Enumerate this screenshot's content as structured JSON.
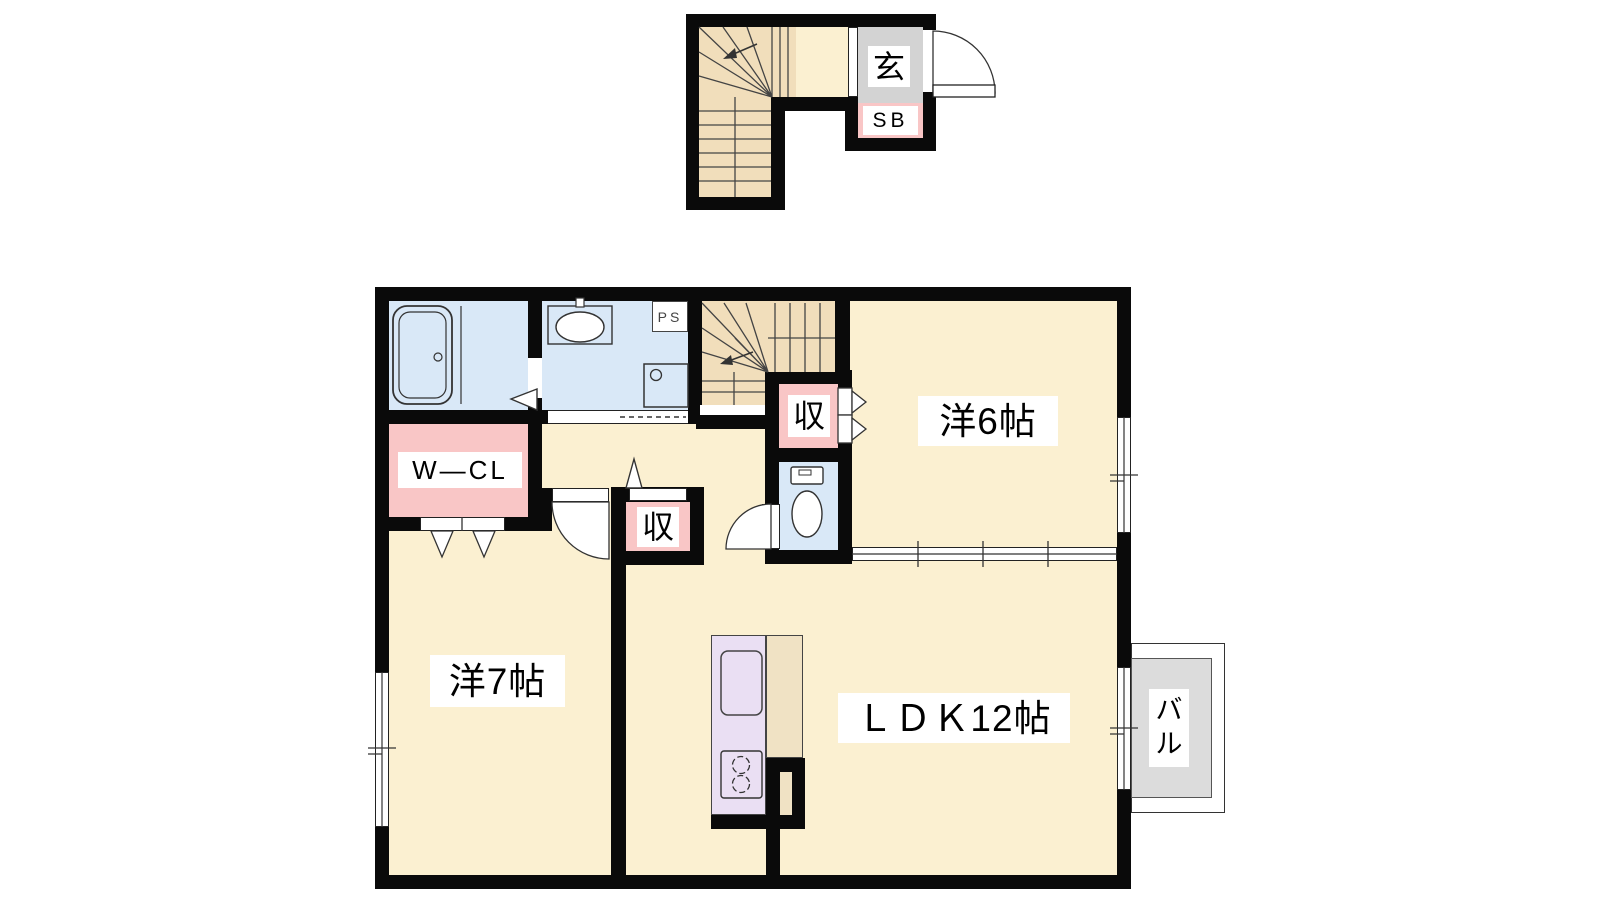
{
  "title": "apartment-floor-plan",
  "labels": {
    "genkan": "玄",
    "shoe_box": "SB",
    "pipe_space": "PS",
    "walk_in_closet": "W―CL",
    "storage": "収",
    "western_room_6": "洋6帖",
    "western_room_7": "洋7帖",
    "ldk": "ＬＤＫ12帖",
    "balcony_1": "バ",
    "balcony_2": "ル"
  },
  "fixtures": [
    "bathtub-icon",
    "washbasin-icon",
    "washing-machine-icon",
    "toilet-icon",
    "kitchen-sink-icon",
    "stove-icon",
    "staircase-icon",
    "door-swing-icon",
    "folding-door-arrow-icon",
    "window-icon",
    "sliding-partition-icon"
  ],
  "colors": {
    "wall": "#0a0a0a",
    "floor": "#FBF0D1",
    "stair": "#F1DEBB",
    "water": "#D9E8F7",
    "pink": "#F9C6C6",
    "kitchen": "#EADFF3",
    "counter": "#F0E2C4",
    "genkan": "#D3D3D3",
    "balcony": "#DCDCDC",
    "line": "#333333"
  }
}
